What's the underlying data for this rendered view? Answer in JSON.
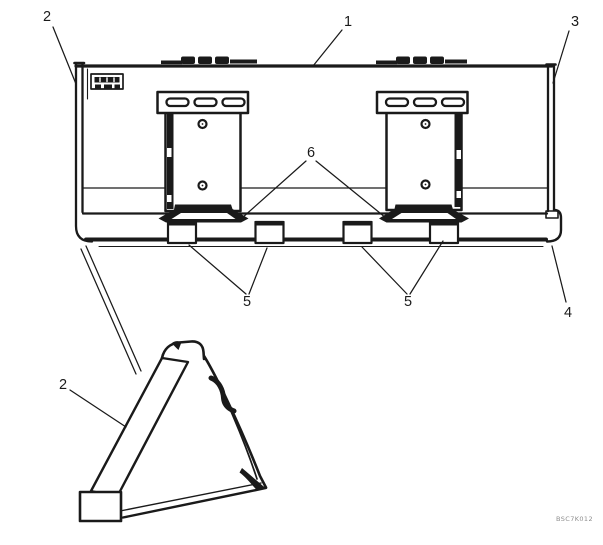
{
  "drawing": {
    "code": "BSC7K012",
    "callouts": [
      {
        "label": "1"
      },
      {
        "label": "2"
      },
      {
        "label": "3"
      },
      {
        "label": "4"
      },
      {
        "label": "5"
      },
      {
        "label": "5"
      },
      {
        "label": "6"
      },
      {
        "label": "2"
      }
    ],
    "line_color": "#1a1a1a",
    "background_color": "#ffffff"
  }
}
